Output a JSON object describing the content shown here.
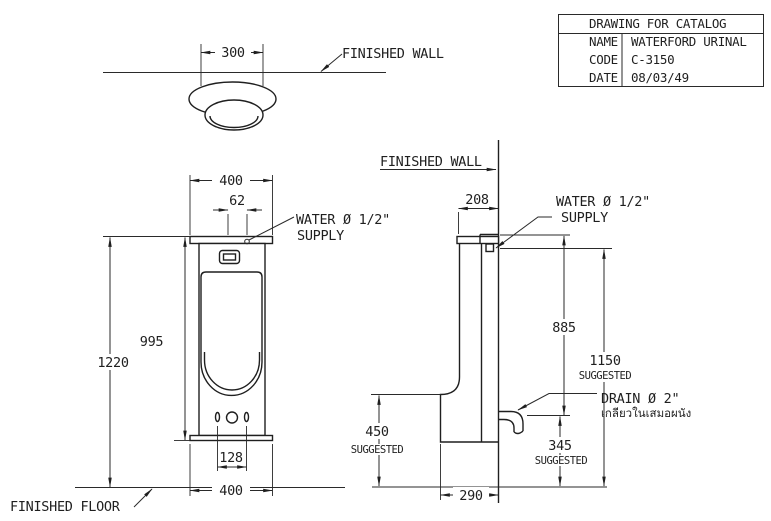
{
  "title_block": {
    "title": "DRAWING FOR CATALOG",
    "rows": [
      {
        "label": "NAME",
        "value": "WATERFORD URINAL"
      },
      {
        "label": "CODE",
        "value": "C-3150"
      },
      {
        "label": "DATE",
        "value": "08/03/49"
      }
    ]
  },
  "top_view": {
    "width_dim": "300",
    "finished_wall_label": "FINISHED WALL"
  },
  "front_view": {
    "top_width_dim": "400",
    "supply_offset_dim": "62",
    "water_supply_line1": "WATER Ø 1/2\"",
    "water_supply_line2": "SUPPLY",
    "height_dim": "995",
    "total_height_dim": "1220",
    "hole_spacing_dim": "128",
    "bottom_width_dim": "400",
    "finished_floor_label": "FINISHED FLOOR"
  },
  "side_view": {
    "finished_wall_label": "FINISHED WALL",
    "depth_dim": "208",
    "water_supply_line1": "WATER Ø 1/2\"",
    "water_supply_line2": "SUPPLY",
    "top_to_drain_dim": "885",
    "rim_height_dim": "1150",
    "rim_height_note": "SUGGESTED",
    "drain_label": "DRAIN Ø 2\"",
    "drain_note_thai": "เกลียวในเสมอผนัง",
    "lip_height_dim": "450",
    "lip_height_note": "SUGGESTED",
    "drain_height_dim": "345",
    "drain_height_note": "SUGGESTED",
    "bottom_depth_dim": "290"
  },
  "colors": {
    "line": "#1f1f1f",
    "background": "#ffffff"
  }
}
